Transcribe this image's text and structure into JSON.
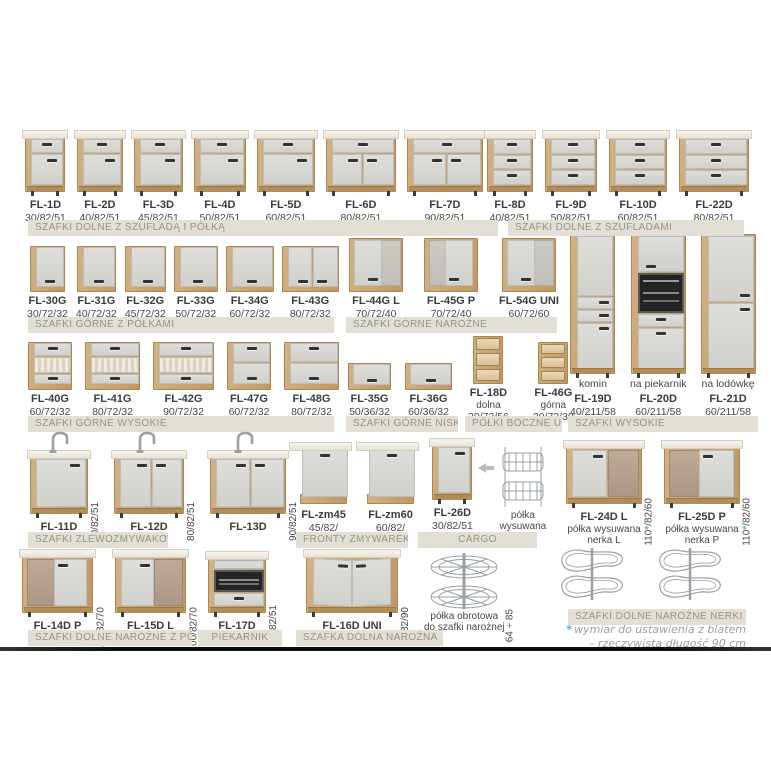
{
  "colors": {
    "wood": "#c7a26e",
    "front": "#d8d9d5",
    "bar_bg": "#e4dfd4",
    "bar_text": "#9a9280",
    "accent_blue": "#41b5d6"
  },
  "footnote": {
    "star": "*",
    "line1": "wymiar do ustawienia z blatem",
    "line2": "– rzeczywista długość 90 cm"
  },
  "groups": {
    "g1": {
      "label": "SZAFKI DOLNE Z SZUFLADĄ I PÓŁKĄ",
      "items": [
        {
          "code": "FL-1D",
          "dims": "30/82/51",
          "type": "base-dd"
        },
        {
          "code": "FL-2D",
          "dims": "40/82/51",
          "type": "base-dd"
        },
        {
          "code": "FL-3D",
          "dims": "45/82/51",
          "type": "base-dd"
        },
        {
          "code": "FL-4D",
          "dims": "50/82/51",
          "type": "base-dd"
        },
        {
          "code": "FL-5D",
          "dims": "60/82/51",
          "type": "base-dd"
        },
        {
          "code": "FL-6D",
          "dims": "80/82/51",
          "type": "base-dd"
        },
        {
          "code": "FL-7D",
          "dims": "90/82/51",
          "type": "base-dd"
        }
      ]
    },
    "g2": {
      "label": "SZAFKI DOLNE Z SZUFLADAMI",
      "items": [
        {
          "code": "FL-8D",
          "dims": "40/82/51",
          "type": "base-3dr"
        },
        {
          "code": "FL-9D",
          "dims": "50/82/51",
          "type": "base-3dr"
        },
        {
          "code": "FL-10D",
          "dims": "60/82/51",
          "type": "base-3dr"
        },
        {
          "code": "FL-22D",
          "dims": "80/82/51",
          "type": "base-3dr"
        }
      ]
    },
    "g3": {
      "label": "SZAFKI GÓRNE Z PÓŁKAMI",
      "items": [
        {
          "code": "FL-30G",
          "dims": "30/72/32",
          "type": "upper"
        },
        {
          "code": "FL-31G",
          "dims": "40/72/32",
          "type": "upper"
        },
        {
          "code": "FL-32G",
          "dims": "45/72/32",
          "type": "upper"
        },
        {
          "code": "FL-33G",
          "dims": "50/72/32",
          "type": "upper"
        },
        {
          "code": "FL-34G",
          "dims": "60/72/32",
          "type": "upper"
        },
        {
          "code": "FL-43G",
          "dims": "80/72/32",
          "type": "upper"
        }
      ]
    },
    "g4": {
      "label": "SZAFKI GÓRNE NAROŻNE",
      "items": [
        {
          "code": "FL-44G L",
          "dims": "70/72/40",
          "type": "upper-corner",
          "variant": "L"
        },
        {
          "code": "FL-45G P",
          "dims": "70/72/40",
          "type": "upper-corner",
          "variant": "P"
        },
        {
          "code": "FL-54G UNI",
          "dims": "60/72/60",
          "type": "upper-corner",
          "variant": "UNI"
        }
      ]
    },
    "g5": {
      "label": "SZAFKI GÓRNE WYSOKIE",
      "items": [
        {
          "code": "FL-40G",
          "dims": "60/72/32",
          "type": "upper-tall",
          "variant": "glass"
        },
        {
          "code": "FL-41G",
          "dims": "80/72/32",
          "type": "upper-tall",
          "variant": "glass"
        },
        {
          "code": "FL-42G",
          "dims": "90/72/32",
          "type": "upper-tall",
          "variant": "glass"
        },
        {
          "code": "FL-47G",
          "dims": "60/72/32",
          "type": "upper-tall",
          "variant": "plain"
        },
        {
          "code": "FL-48G",
          "dims": "80/72/32",
          "type": "upper-tall",
          "variant": "plain"
        }
      ]
    },
    "g6": {
      "label": "SZAFKI GÓRNE NISKIE",
      "items": [
        {
          "code": "FL-35G",
          "dims": "50/36/32",
          "type": "upper-low"
        },
        {
          "code": "FL-36G",
          "dims": "60/36/32",
          "type": "upper-low"
        }
      ]
    },
    "g7": {
      "label": "PÓŁKI BOCZNE UNI",
      "items": [
        {
          "code": "FL-18D",
          "note": "dolna",
          "dims": "20/72/56",
          "type": "shelf-open"
        },
        {
          "code": "FL-46G",
          "note": "górna",
          "dims": "20/72/30",
          "type": "shelf-open"
        }
      ]
    },
    "g8": {
      "label": "SZAFKI WYSOKIE",
      "items": [
        {
          "code": "FL-19D",
          "topnote": "komin",
          "dims": "40/211/58",
          "type": "tall",
          "variant": "komin"
        },
        {
          "code": "FL-20D",
          "topnote": "na piekarnik",
          "dims": "60/211/58",
          "type": "tall",
          "variant": "oven"
        },
        {
          "code": "FL-21D",
          "topnote": "na lodówkę",
          "dims": "60/211/58",
          "type": "tall",
          "variant": "fridge"
        }
      ]
    },
    "g9": {
      "label": "SZAFKI ZLEWOZMYWAKOWE",
      "items": [
        {
          "code": "FL-11D",
          "vdim": "60/82/51",
          "type": "sink"
        },
        {
          "code": "FL-12D",
          "vdim": "80/82/51",
          "type": "sink"
        },
        {
          "code": "FL-13D",
          "vdim": "90/82/51",
          "type": "sink"
        }
      ]
    },
    "g10": {
      "label": "FRONTY ZMYWAREK",
      "items": [
        {
          "code": "FL-zm45",
          "dims": "45/82/",
          "type": "dw-front"
        },
        {
          "code": "FL-zm60",
          "dims": "60/82/",
          "type": "dw-front"
        }
      ]
    },
    "g11": {
      "label": "CARGO",
      "items": [
        {
          "code": "FL-26D",
          "dims": "30/82/51",
          "type": "cargo-base"
        },
        {
          "type": "arrow"
        },
        {
          "note": "półka\nwysuwana",
          "type": "cargo-basket"
        }
      ]
    },
    "g12": {
      "label": "SZAFKI DOLNE NAROŻNE NERKI",
      "items": [
        {
          "code": "FL-24D L",
          "note": "półka wysuwana\nnerka L",
          "vdim": "110*/82/60",
          "type": "corner-base",
          "variant": "L"
        },
        {
          "code": "FL-25D P",
          "note": "półka wysuwana\nnerka P",
          "vdim": "110*/82/60",
          "type": "corner-base",
          "variant": "P"
        }
      ]
    },
    "g13": {
      "label": "SZAFKI DOLNE NAROŻNE Z PÓŁKĄ",
      "label2": "PIEKARNIK",
      "items": [
        {
          "code": "FL-14D P",
          "vdim": "100/82/70",
          "type": "corner-base",
          "variant": "P"
        },
        {
          "code": "FL-15D L",
          "vdim": "100/82/70",
          "type": "corner-base",
          "variant": "L"
        },
        {
          "code": "FL-17D",
          "vdim": "60/82/51",
          "type": "oven-base"
        }
      ]
    },
    "g14": {
      "label": "SZAFKA DOLNA NAROŻNA",
      "items": [
        {
          "code": "FL-16D UNI",
          "vdim": "90/82/90",
          "type": "corner-uni"
        },
        {
          "note": "półka obrotowa\ndo szafki narożnej",
          "vdim": "64 ÷ 85",
          "type": "rotary"
        }
      ]
    },
    "g15": {
      "items": [
        {
          "type": "nerka"
        },
        {
          "type": "nerka"
        }
      ]
    }
  }
}
